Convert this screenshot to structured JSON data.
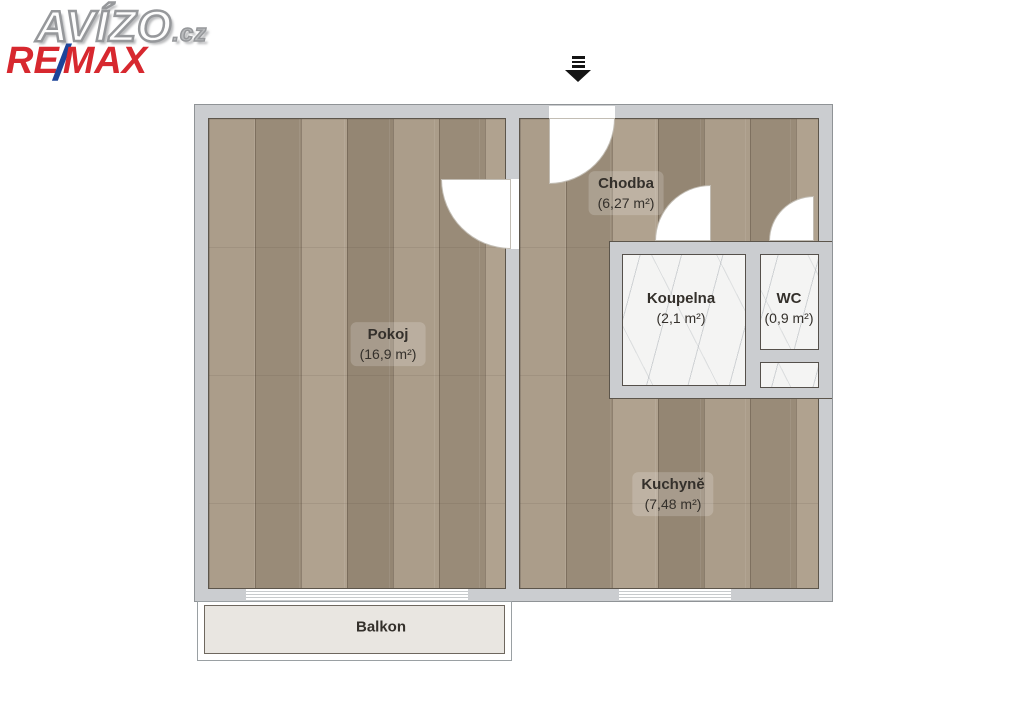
{
  "branding": {
    "avizo_text": "AVÍZO",
    "avizo_tld": ".cz",
    "remax_re": "RE",
    "remax_slash": "/",
    "remax_max": "MAX",
    "colors": {
      "remax_red": "#d7282f",
      "remax_blue": "#1c4499"
    }
  },
  "floorplan": {
    "entrance_marker": "entrance-arrow-down-icon",
    "colors": {
      "wall": "#cbcdd0",
      "wood_floor": "#a29480",
      "marble_floor": "#f4f4f3",
      "balcony_floor": "#e9e6e1"
    },
    "rooms": [
      {
        "name": "Pokoj",
        "area": "(16,9 m²)"
      },
      {
        "name": "Chodba",
        "area": "(6,27 m²)"
      },
      {
        "name": "Koupelna",
        "area": "(2,1 m²)"
      },
      {
        "name": "WC",
        "area": "(0,9 m²)"
      },
      {
        "name": "Kuchyně",
        "area": "(7,48 m²)"
      },
      {
        "name": "Balkon",
        "area": ""
      }
    ]
  }
}
